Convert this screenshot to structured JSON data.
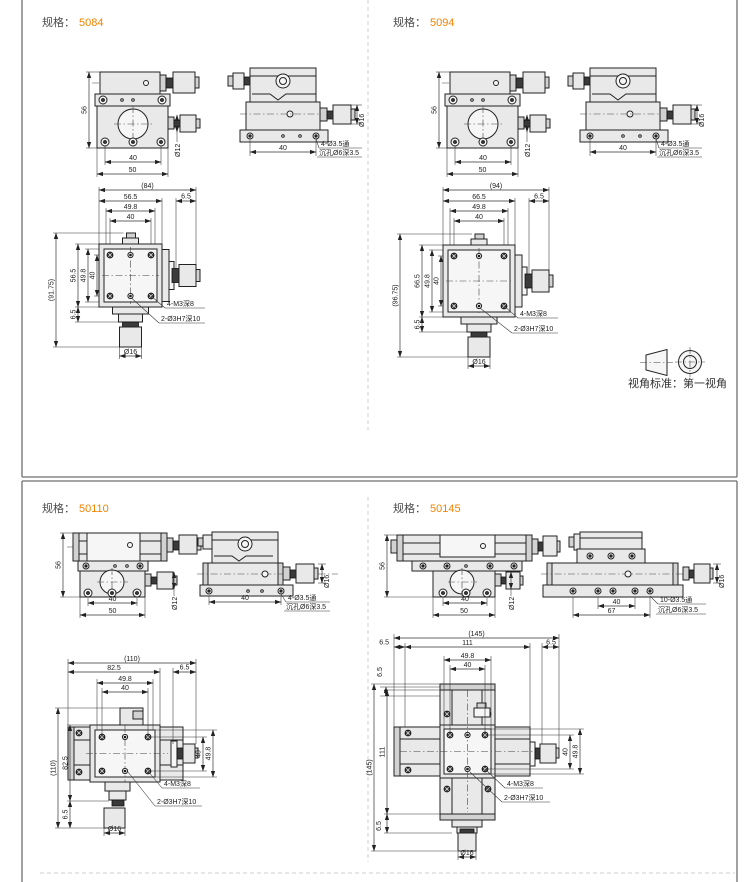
{
  "page": {
    "projection_label": "视角标准：",
    "projection_value": "第一视角"
  },
  "accent_color": "#f08300",
  "sections": [
    {
      "spec_label": "规格：",
      "spec_value": "5084",
      "front": {
        "height": "56",
        "pitch": "40",
        "base": "50",
        "knob": "Ø12"
      },
      "side": {
        "pitch": "40",
        "holes": "4-Ø3.5通",
        "cbore": "沉孔Ø6深3.5",
        "knob": "Ø16"
      },
      "plan": {
        "total_w": "(84)",
        "w1": "56.5",
        "w2": "49.8",
        "w3": "40",
        "w_off": "6.5",
        "total_h": "(91.75)",
        "h1": "56.5",
        "h2": "49.8",
        "h3": "40",
        "h_off": "6.5",
        "thread": "4-M3深8",
        "pins": "2-Ø3H7深10",
        "knob": "Ø16"
      }
    },
    {
      "spec_label": "规格：",
      "spec_value": "5094",
      "front": {
        "height": "56",
        "pitch": "40",
        "base": "50",
        "knob": "Ø12"
      },
      "side": {
        "pitch": "40",
        "holes": "4-Ø3.5通",
        "cbore": "沉孔Ø6深3.5",
        "knob": "Ø16"
      },
      "plan": {
        "total_w": "(94)",
        "w1": "66.5",
        "w2": "49.8",
        "w3": "40",
        "w_off": "6.5",
        "total_h": "(96.75)",
        "h1": "66.5",
        "h2": "49.8",
        "h3": "40",
        "h_off": "6.5",
        "thread": "4-M3深8",
        "pins": "2-Ø3H7深10",
        "knob": "Ø16"
      }
    },
    {
      "spec_label": "规格：",
      "spec_value": "50110",
      "front": {
        "height": "56",
        "pitch": "40",
        "base": "50",
        "knob": "Ø12"
      },
      "side": {
        "pitch": "40",
        "holes": "4-Ø3.5通",
        "cbore": "沉孔Ø6深3.5",
        "knob": "Ø16"
      },
      "plan": {
        "total_w": "(110)",
        "w1": "82.5",
        "w2": "49.8",
        "w3": "40",
        "w_off": "6.5",
        "total_h": "(110)",
        "h1": "82.5",
        "h_off": "6.5",
        "r1": "40",
        "r2": "49.8",
        "thread": "4-M3深8",
        "pins": "2-Ø3H7深10",
        "knob": "Ø16"
      }
    },
    {
      "spec_label": "规格：",
      "spec_value": "50145",
      "front": {
        "height": "56",
        "pitch": "40",
        "base": "50",
        "knob": "Ø12"
      },
      "side": {
        "pitch": "40",
        "base": "67",
        "holes": "10-Ø3.5通",
        "cbore": "沉孔Ø6深3.5",
        "knob": "Ø16"
      },
      "plan": {
        "total_w": "(145)",
        "w1": "111",
        "w2": "49.8",
        "w3": "40",
        "w_off_l": "6.5",
        "w_off_r": "6.5",
        "v_off": "6.5",
        "total_h": "(145)",
        "h1": "111",
        "h_off": "6.5",
        "r1": "40",
        "r2": "49.8",
        "thread": "4-M3深8",
        "pins": "2-Ø3H7深10",
        "knob": "Ø16"
      }
    }
  ]
}
